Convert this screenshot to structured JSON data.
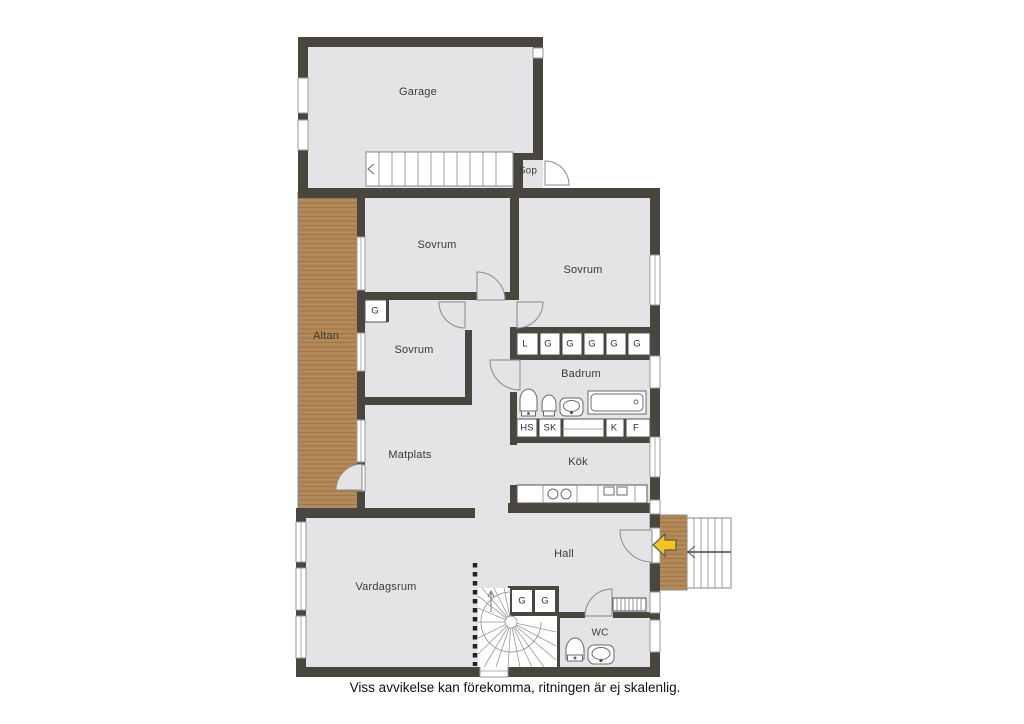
{
  "rooms": {
    "garage": "Garage",
    "sop": "Sop",
    "sovrum1": "Sovrum",
    "sovrum2": "Sovrum",
    "sovrum3": "Sovrum",
    "altan": "Altan",
    "badrum": "Badrum",
    "matplats": "Matplats",
    "kok": "Kök",
    "hall": "Hall",
    "vardagsrum": "Vardagsrum",
    "wc": "WC"
  },
  "closets": {
    "sovrum3_g": "G",
    "hall_row": [
      "L",
      "G",
      "G",
      "G",
      "G",
      "G"
    ],
    "kitchen_row": [
      "HS",
      "SK",
      "K",
      "F"
    ],
    "entry_g": [
      "G",
      "G"
    ]
  },
  "footer": {
    "disclaimer": "Viss avvikelse kan förekomma, ritningen är ej skalenlig."
  },
  "colors": {
    "wall": "#48463e",
    "floor": "#e4e4e6",
    "wood": "#b3895a",
    "arrow": "#f6c31a"
  }
}
